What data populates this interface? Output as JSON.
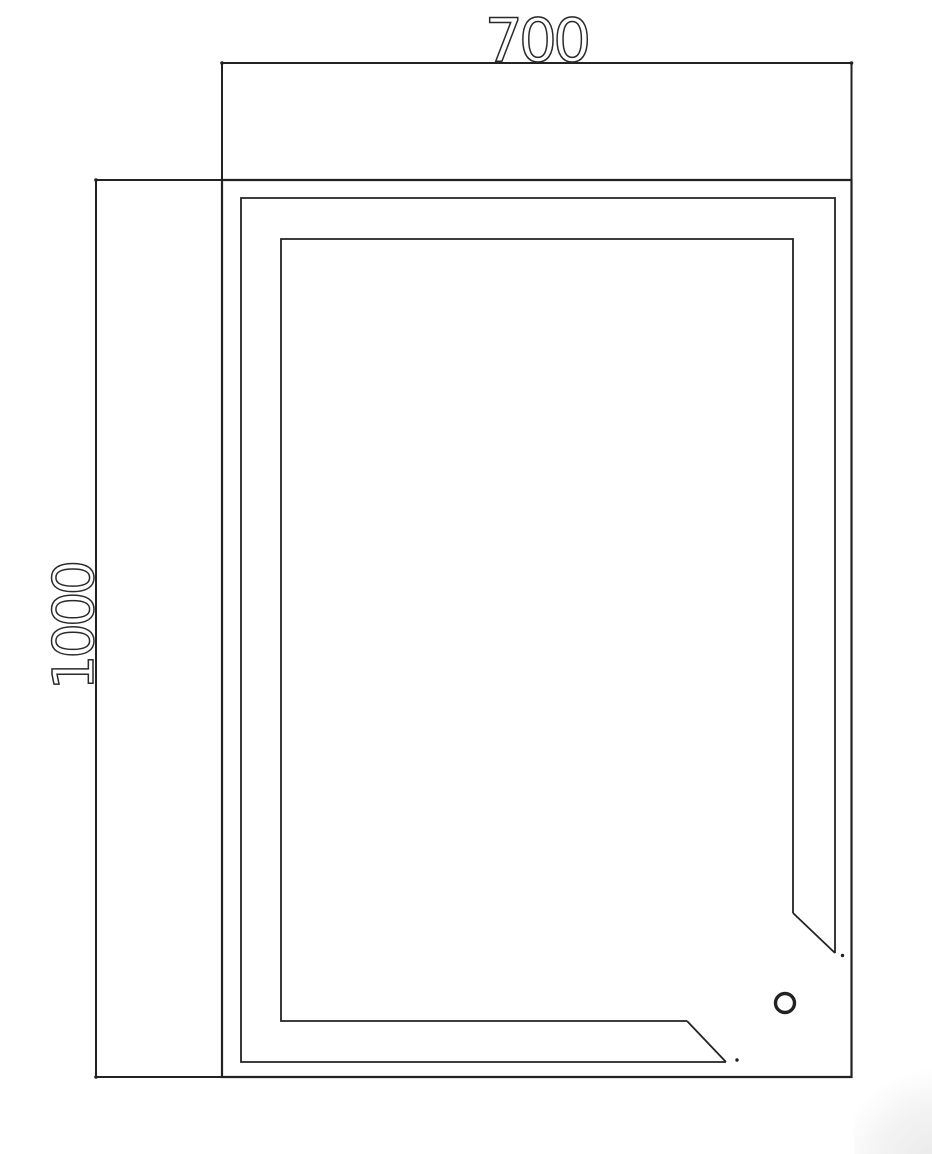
{
  "drawing": {
    "type": "cad-plan-view",
    "dimensions": {
      "width_label": "700",
      "height_label": "1000"
    }
  },
  "colors": {
    "line": "#222222",
    "background": "#ffffff",
    "corner_shade": "#e9e9e9"
  }
}
